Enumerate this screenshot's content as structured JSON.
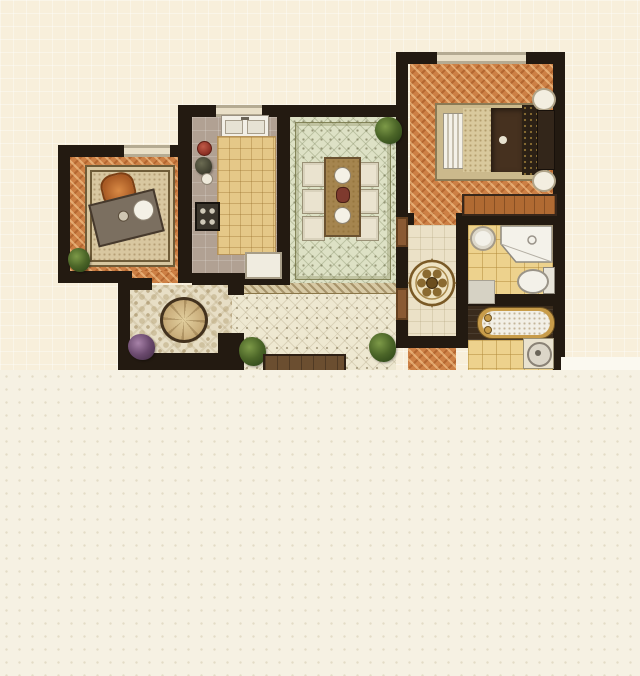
{
  "title": "apartment-floor-plan",
  "palette": {
    "bg_upper": "#f8efdb",
    "bg_lower": "#f6f1e3",
    "white_patch": "#fbf9f0",
    "wall": "#231a11",
    "window": "#e9dfc7",
    "door": "#8a5a33",
    "wood_floor": "#cd8045",
    "kitchen_floor": "#b1a193",
    "counter": "#e5c888",
    "dining_floor": "#dde1c5",
    "living_floor": "#eee8d1",
    "entry_floor": "#e7dec5",
    "hall_floor": "#ebe1c7",
    "bath_tile": "#edd28d",
    "tub_room_floor": "#3a2b1c",
    "bed_frame": "#cbb98c",
    "bed_blanket": "#46311f",
    "dresser_wood": "#b06a32",
    "table_wood": "#a5854f",
    "fixture_white": "#f3f1e9",
    "gold": "#c89c4a"
  },
  "rooms": [
    {
      "id": "study",
      "floor": "wood-herringbone"
    },
    {
      "id": "kitchen",
      "floor": "gray-tile"
    },
    {
      "id": "dining-room",
      "floor": "green-tile"
    },
    {
      "id": "master-bedroom",
      "floor": "wood-herringbone"
    },
    {
      "id": "hallway",
      "floor": "cream-tile"
    },
    {
      "id": "bathroom",
      "floor": "yellow-tile"
    },
    {
      "id": "bath-tub-room",
      "floor": "dark-wood"
    },
    {
      "id": "entry-hall",
      "floor": "patterned-tile"
    },
    {
      "id": "living-room",
      "floor": "cream-tile"
    },
    {
      "id": "lower-bedroom",
      "floor": "wood-herringbone"
    }
  ],
  "furniture": [
    "desk",
    "desk-chair",
    "area-rug",
    "bed",
    "nightstand",
    "wardrobe",
    "dresser",
    "dining-table",
    "dining-chair",
    "kitchen-sink",
    "kitchen-counter",
    "stove",
    "fridge",
    "compass-medallion",
    "corner-shower",
    "wash-basin",
    "toilet",
    "bathtub",
    "washer",
    "round-rug",
    "tv-cabinet",
    "potted-plant"
  ]
}
